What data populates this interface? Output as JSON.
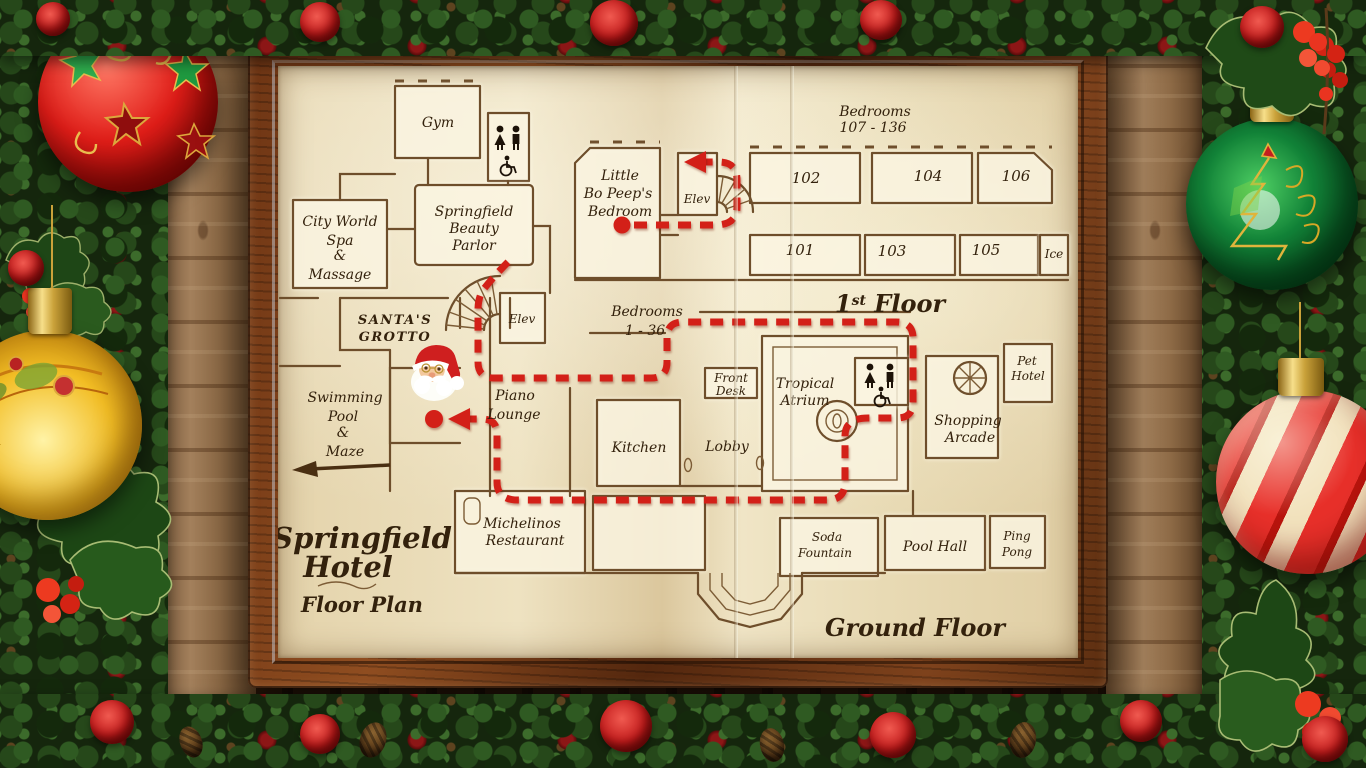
{
  "map": {
    "hotel_title": [
      "Springfield",
      "Hotel"
    ],
    "plan_subtitle": "Floor Plan",
    "floor_ground": "Ground Floor",
    "floor_first": {
      "num": "1",
      "sup": "st",
      "word": " Floor"
    },
    "wings": {
      "bedrooms_first": [
        "Bedrooms",
        "107 - 136"
      ],
      "bedrooms_ground": [
        "Bedrooms",
        "1 - 36"
      ]
    },
    "rooms": {
      "gym": "Gym",
      "spa": [
        "City World",
        "Spa",
        "&",
        "Massage"
      ],
      "beauty_parlor": [
        "Springfield",
        "Beauty",
        "Parlor"
      ],
      "santas_grotto": [
        "SANTA'S",
        "GROTTO"
      ],
      "swimming_pool": [
        "Swimming",
        "Pool",
        "&",
        "Maze"
      ],
      "piano_lounge": [
        "Piano",
        "Lounge"
      ],
      "michelinos": [
        "Michelinos",
        "Restaurant"
      ],
      "kitchen": "Kitchen",
      "lobby": "Lobby",
      "front_desk": [
        "Front",
        "Desk"
      ],
      "tropical_atrium": [
        "Tropical",
        "Atrium"
      ],
      "shopping_arcade": [
        "Shopping",
        "Arcade"
      ],
      "pet_hotel": [
        "Pet",
        "Hotel"
      ],
      "soda_fountain": [
        "Soda",
        "Fountain"
      ],
      "pool_hall": "Pool Hall",
      "ping_pong": [
        "Ping",
        "Pong"
      ],
      "little_bo_peep": [
        "Little",
        "Bo Peep's",
        "Bedroom"
      ],
      "elevator_ground": "Elev",
      "elevator_first": "Elev",
      "ice": "Ice"
    },
    "room_numbers": {
      "r101": "101",
      "r102": "102",
      "r103": "103",
      "r104": "104",
      "r105": "105",
      "r106": "106"
    },
    "colors": {
      "route": "#d32018",
      "ink": "#6e4e2b",
      "paper": "#e8dab6",
      "frame": "#6b3a18"
    }
  },
  "route": {
    "color": "#d32018",
    "style": "dashed",
    "dots": 2,
    "arrows": 2
  },
  "decor": {
    "ornaments": [
      {
        "name": "red-ball-with-stars",
        "color": "#c81e1e"
      },
      {
        "name": "gold-ball",
        "color": "#e8b62a"
      },
      {
        "name": "green-ball-with-tree",
        "color": "#0d6b2c"
      },
      {
        "name": "candy-stripe-ball",
        "color": "#e32a22"
      }
    ],
    "garland": "pine-with-roses-berries-and-pinecones",
    "frame": "dark-wood-picture-frame"
  }
}
